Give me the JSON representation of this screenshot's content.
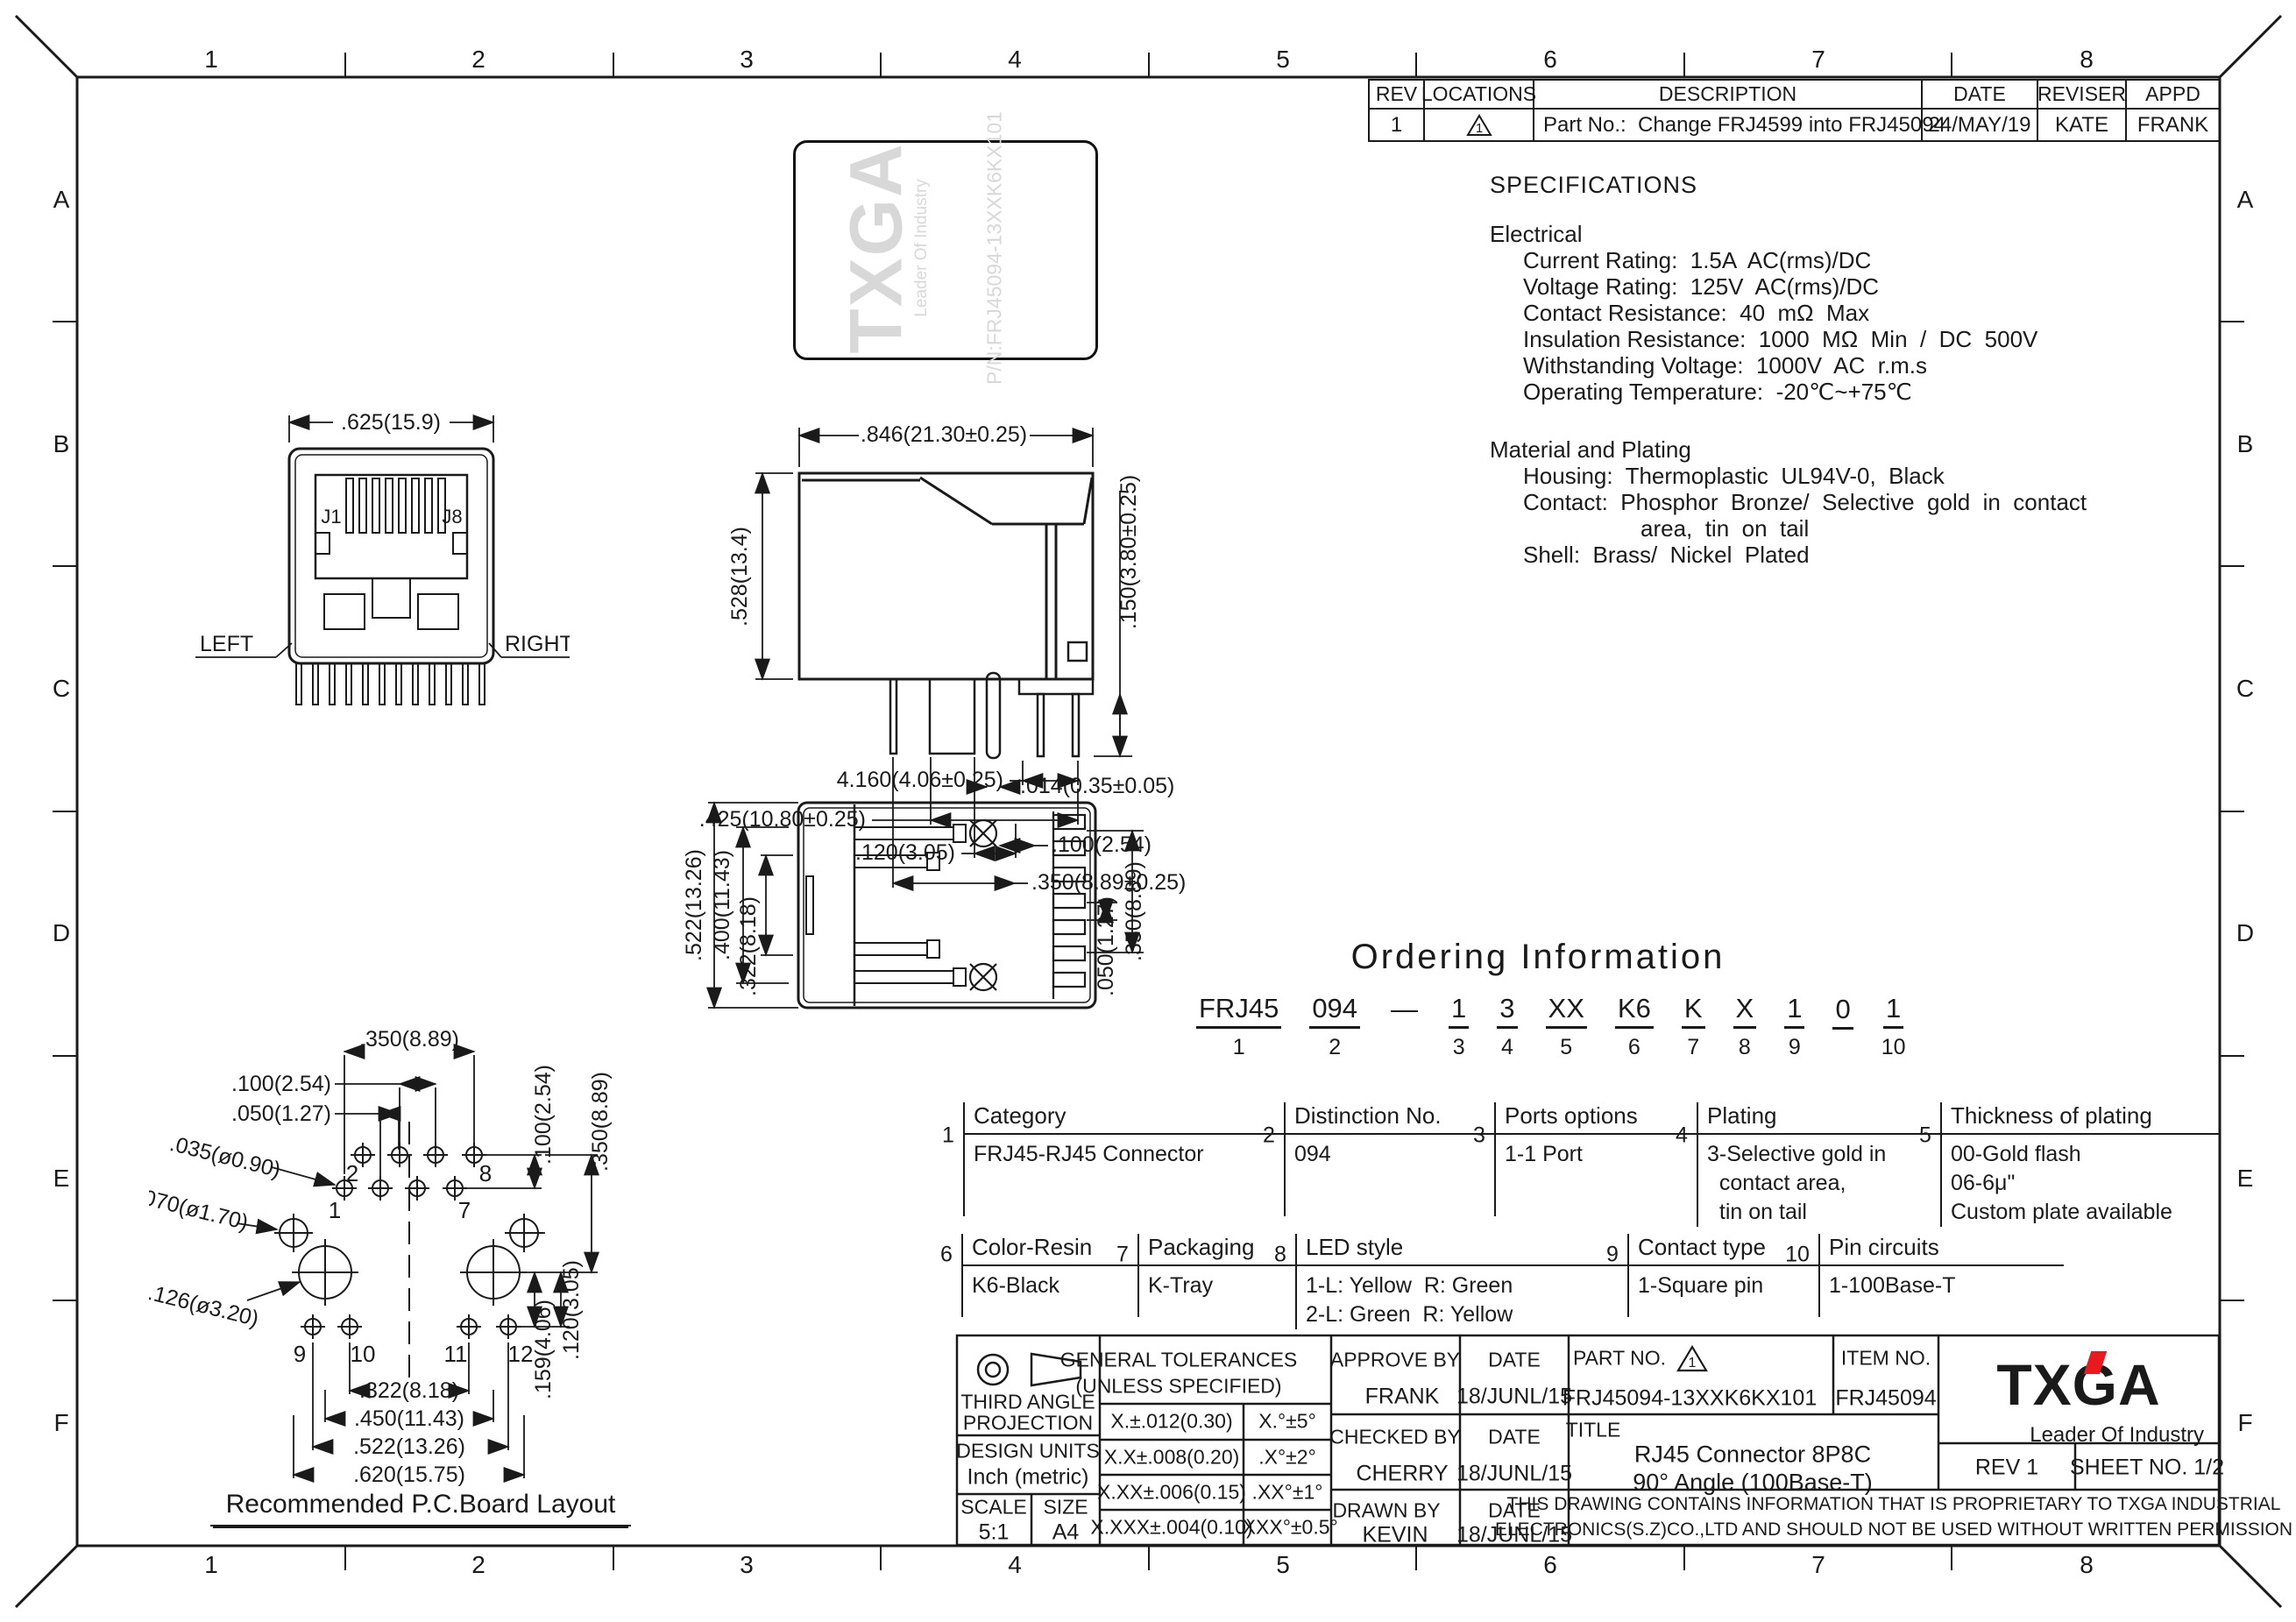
{
  "colors": {
    "ink": "#1a1a1a",
    "accent_red": "#e8191f",
    "watermark_gray": "#d8d8d8"
  },
  "frame": {
    "columns": [
      "1",
      "2",
      "3",
      "4",
      "5",
      "6",
      "7",
      "8"
    ],
    "rows": [
      "A",
      "B",
      "C",
      "D",
      "E",
      "F"
    ]
  },
  "revision": {
    "headers": {
      "rev": "REV",
      "locations": "LOCATIONS",
      "description": "DESCRIPTION",
      "date": "DATE",
      "reviser": "REVISER",
      "appd": "APPD"
    },
    "entry": {
      "rev": "1",
      "location_mark": "1",
      "description": "Part No.:  Change FRJ4599 into FRJ45094",
      "date": "24/MAY/19",
      "reviser": "KATE",
      "appd": "FRANK"
    }
  },
  "product_image": {
    "brand": "TXGA",
    "tagline": "Leader Of Industry",
    "part_marking": "P/N:FRJ45094-13XXK6KX101"
  },
  "specs": {
    "title": "SPECIFICATIONS",
    "electrical_heading": "Electrical",
    "electrical_lines": [
      "Current Rating:  1.5A  AC(rms)/DC",
      "Voltage Rating:  125V  AC(rms)/DC",
      "Contact Resistance:  40  mΩ  Max",
      "Insulation Resistance:  1000  MΩ  Min  /  DC  500V",
      "Withstanding Voltage:  1000V  AC  r.m.s",
      "Operating Temperature:  -20℃~+75℃"
    ],
    "material_heading": "Material and Plating",
    "material_lines": [
      "Housing:  Thermoplastic  UL94V-0,  Black",
      "Contact:  Phosphor  Bronze/  Selective  gold  in  contact",
      "area,  tin  on  tail",
      "Shell:  Brass/  Nickel  Plated"
    ]
  },
  "front_view": {
    "width_dim": ".625(15.9)",
    "pin_first": "J1",
    "pin_last": "J8",
    "label_left": "LEFT",
    "label_right": "RIGHT"
  },
  "side_view": {
    "dim_width": ".846(21.30±0.25)",
    "dim_height": ".528(13.4)",
    "dim_pin": ".150(3.80±0.25)",
    "dim_a": "4.160(4.06±0.25)",
    "dim_b": ".425(10.80±0.25)",
    "dim_c": ".120(3.05)",
    "dim_d": ".014(0.35±0.05)",
    "dim_e": ".100(2.54)",
    "dim_f": ".350(8.89±0.25)"
  },
  "bottom_view": {
    "dim_a": ".522(13.26)",
    "dim_b": ".400(11.43)",
    "dim_c": ".322(8.18)",
    "dim_d": ".050(1.27)",
    "dim_e": ".350(8.89)"
  },
  "pcb_layout": {
    "title": "Recommended P.C.Board Layout",
    "dim_top": ".350(8.89)",
    "dim_pitch": ".100(2.54)",
    "dim_half": ".050(1.27)",
    "dim_hole_s": ".035(ø0.90)",
    "dim_hole_m": ".070(ø1.70)",
    "dim_hole_l": ".126(ø3.20)",
    "dim_r1": ".100(2.54)",
    "dim_r2": ".350(8.89)",
    "dim_r3": ".120(3.05)",
    "dim_r4": ".159(4.06)",
    "dim_b1": ".322(8.18)",
    "dim_b2": ".450(11.43)",
    "dim_b3": ".522(13.26)",
    "dim_b4": ".620(15.75)",
    "pins": {
      "p1": "1",
      "p2": "2",
      "p7": "7",
      "p8": "8",
      "p9": "9",
      "p10": "10",
      "p11": "11",
      "p12": "12"
    }
  },
  "ordering": {
    "title": "Ordering Information",
    "segments": [
      {
        "text": "FRJ45",
        "num": "1"
      },
      {
        "text": "094",
        "num": "2"
      },
      {
        "text": "—",
        "num": ""
      },
      {
        "text": "1",
        "num": "3"
      },
      {
        "text": "3",
        "num": "4"
      },
      {
        "text": "XX",
        "num": "5"
      },
      {
        "text": "K6",
        "num": "6"
      },
      {
        "text": "K",
        "num": "7"
      },
      {
        "text": "X",
        "num": "8"
      },
      {
        "text": "1",
        "num": "9"
      },
      {
        "text": "0",
        "num": ""
      },
      {
        "text": "1",
        "num": "10"
      }
    ],
    "boxes_row1": [
      {
        "num": "1",
        "title": "Category",
        "content": "FRJ45-RJ45 Connector"
      },
      {
        "num": "2",
        "title": "Distinction No.",
        "content": "094"
      },
      {
        "num": "3",
        "title": "Ports options",
        "content": "1-1 Port"
      },
      {
        "num": "4",
        "title": "Plating",
        "content": "3-Selective gold in\n  contact area,\n  tin on tail"
      },
      {
        "num": "5",
        "title": "Thickness of plating",
        "content": "00-Gold flash\n06-6μ\"\nCustom plate available"
      }
    ],
    "boxes_row2": [
      {
        "num": "6",
        "title": "Color-Resin",
        "content": "K6-Black"
      },
      {
        "num": "7",
        "title": "Packaging",
        "content": "K-Tray"
      },
      {
        "num": "8",
        "title": "LED style",
        "content": "1-L: Yellow  R: Green\n2-L: Green  R: Yellow"
      },
      {
        "num": "9",
        "title": "Contact type",
        "content": "1-Square pin"
      },
      {
        "num": "10",
        "title": "Pin circuits",
        "content": "1-100Base-T"
      }
    ]
  },
  "title_block": {
    "projection_line1": "THIRD ANGLE",
    "projection_line2": "PROJECTION",
    "design_units_label": "DESIGN UNITS",
    "design_units_value": "Inch (metric)",
    "scale_label": "SCALE",
    "scale_value": "5:1",
    "size_label": "SIZE",
    "size_value": "A4",
    "tol_title": "GENERAL TOLERANCES",
    "tol_sub": "(UNLESS SPECIFIED)",
    "tol_rows": [
      {
        "lin": "X.±.012(0.30)",
        "ang": "X.°±5°"
      },
      {
        "lin": "X.X±.008(0.20)",
        "ang": ".X°±2°"
      },
      {
        "lin": "X.XX±.006(0.15)",
        "ang": ".XX°±1°"
      },
      {
        "lin": "X.XXX±.004(0.10)",
        "ang": ".XXX°±0.5°"
      }
    ],
    "approve_label": "APPROVE BY",
    "approve_name": "FRANK",
    "approve_date": "18/JUNL/15",
    "checked_label": "CHECKED BY",
    "checked_name": "CHERRY",
    "checked_date": "18/JUNL/15",
    "drawn_label": "DRAWN BY",
    "drawn_name": "KEVIN",
    "drawn_date": "18/JUNL/15",
    "date_label": "DATE",
    "part_no_label": "PART NO.",
    "part_no_mark": "1",
    "part_no": "FRJ45094-13XXK6KX101",
    "item_no_label": "ITEM NO.",
    "item_no": "FRJ45094",
    "title_label": "TITLE",
    "title_line1": "RJ45 Connector 8P8C",
    "title_line2": "90° Angle (100Base-T)",
    "brand": "TXGA",
    "brand_tagline": "Leader Of Industry",
    "rev": "REV 1",
    "sheet": "SHEET NO. 1/2",
    "notice_line1": "THIS DRAWING CONTAINS INFORMATION THAT IS PROPRIETARY TO TXGA INDUSTRIAL",
    "notice_line2": "ELECTRONICS(S.Z)CO.,LTD AND SHOULD NOT BE USED WITHOUT WRITTEN PERMISSION"
  }
}
